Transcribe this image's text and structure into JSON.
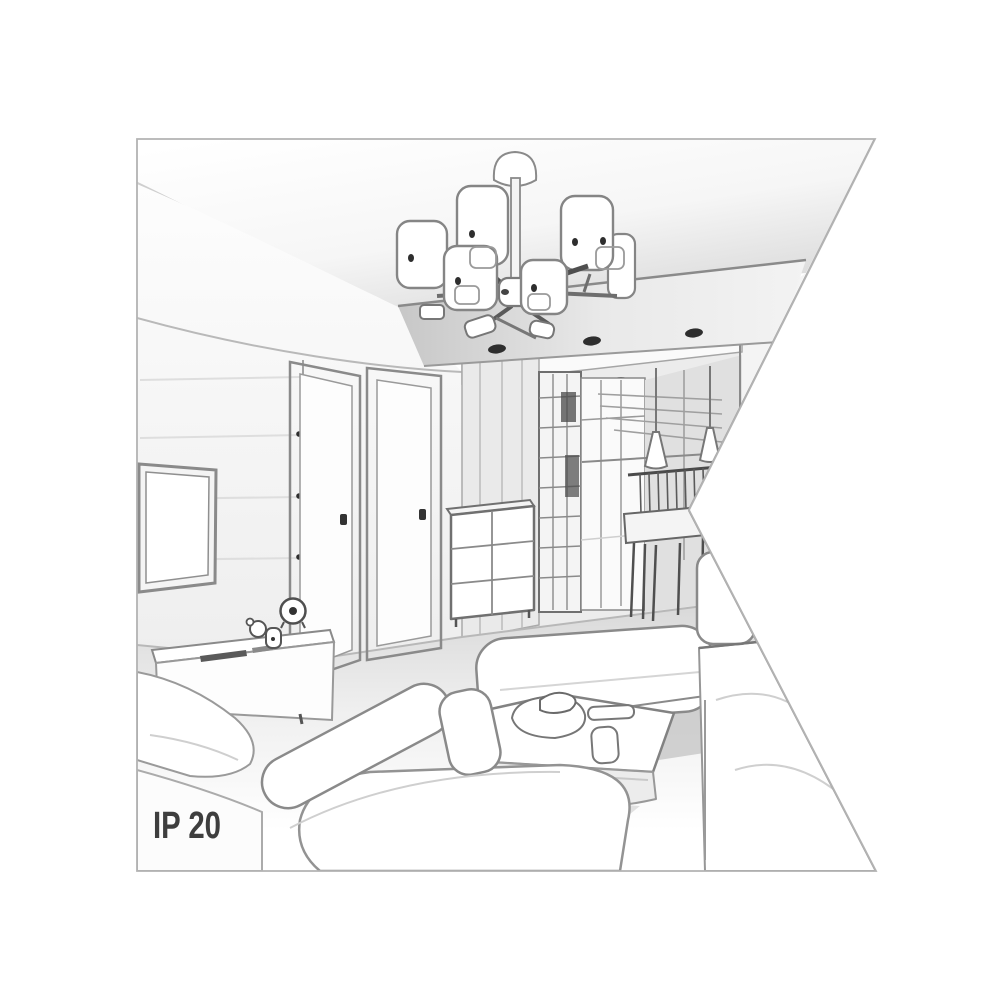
{
  "badge": {
    "ip_rating": "IP 20"
  },
  "palette": {
    "bg": "#ffffff",
    "line-soft": "#cfcfcf",
    "line": "#8a8a8a",
    "line-mid": "#9a9a9a",
    "line-dark": "#555555",
    "ink": "#2e2e2e",
    "label": "#3e3e3e",
    "fill-white": "#ffffff",
    "fill-1": "#f4f4f4",
    "fill-2": "#ececec",
    "fill-3": "#e0e0e0",
    "shadow": "#c9c9c9",
    "border": "#b3b3b3"
  },
  "scene_elements": [
    "ceiling",
    "suspended-ceiling-panel",
    "recessed-spotlights",
    "chandelier-six-cylinder-shades",
    "left-wall-paneling",
    "tv-screen",
    "tv-sideboard",
    "alarm-clock",
    "desk-speakers",
    "door-left",
    "door-right",
    "chest-of-drawers",
    "hallway",
    "wardrobe-grid",
    "back-window",
    "pendant-cone-lights",
    "dining-table-and-chairs",
    "bench-sofa",
    "right-sofa",
    "coffee-table",
    "serving-items",
    "front-sofa",
    "left-armchair",
    "ip-rating-label"
  ]
}
